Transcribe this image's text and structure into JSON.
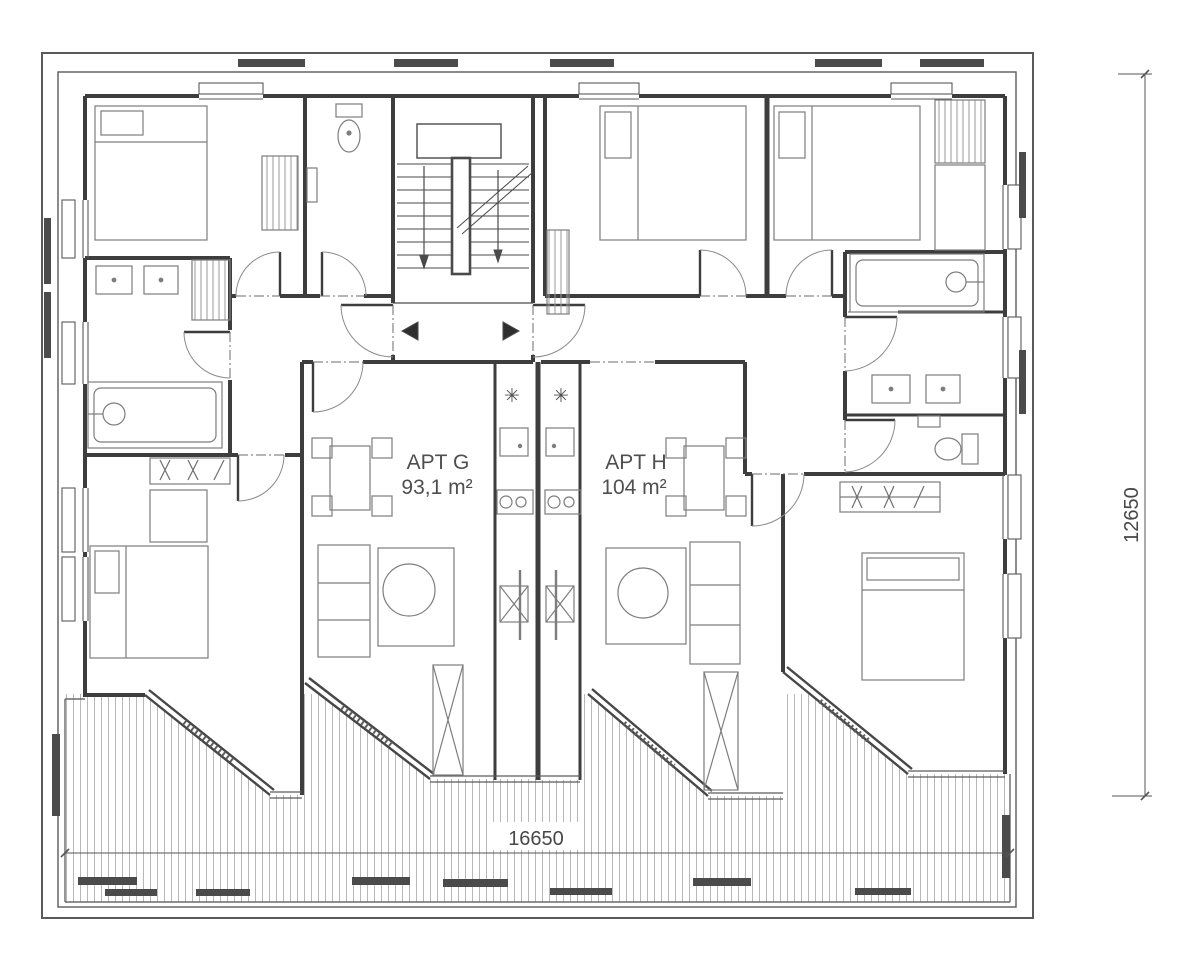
{
  "plan": {
    "type": "architectural-floor-plan",
    "apartments": [
      {
        "name": "APT G",
        "area": "93,1 m²"
      },
      {
        "name": "APT H",
        "area": "104 m²"
      }
    ],
    "dimensions": {
      "width": "16650",
      "height": "12650"
    },
    "icons": {
      "kitchen_vent": "✳"
    },
    "colors": {
      "wall": "#3d3d3d",
      "fixture": "#7d7d7d",
      "hatch": "#b8b8b8",
      "dark_fill": "#4b4b4b",
      "dimension_line": "#555555",
      "text": "#4f4f4f",
      "background": "#ffffff"
    },
    "rooms": [
      "bedroom-top-left",
      "bathroom-top",
      "stair-core",
      "bedroom-top-middle",
      "bedroom-top-right",
      "bathroom-left",
      "bedroom-bottom-left",
      "living-room-apt-g",
      "kitchen-apt-g",
      "kitchen-apt-h",
      "living-room-apt-h",
      "bathroom-right-block",
      "wc-right",
      "bedroom-bottom-right",
      "terrace"
    ],
    "fixtures": [
      "bed",
      "wardrobe",
      "toilet",
      "washbasin",
      "bathtub",
      "sofa",
      "rug",
      "dining-table",
      "chairs",
      "cooktop",
      "kitchen-sink",
      "tall-cabinet",
      "stairs",
      "entry-arrows",
      "planter-screen",
      "bench"
    ]
  }
}
